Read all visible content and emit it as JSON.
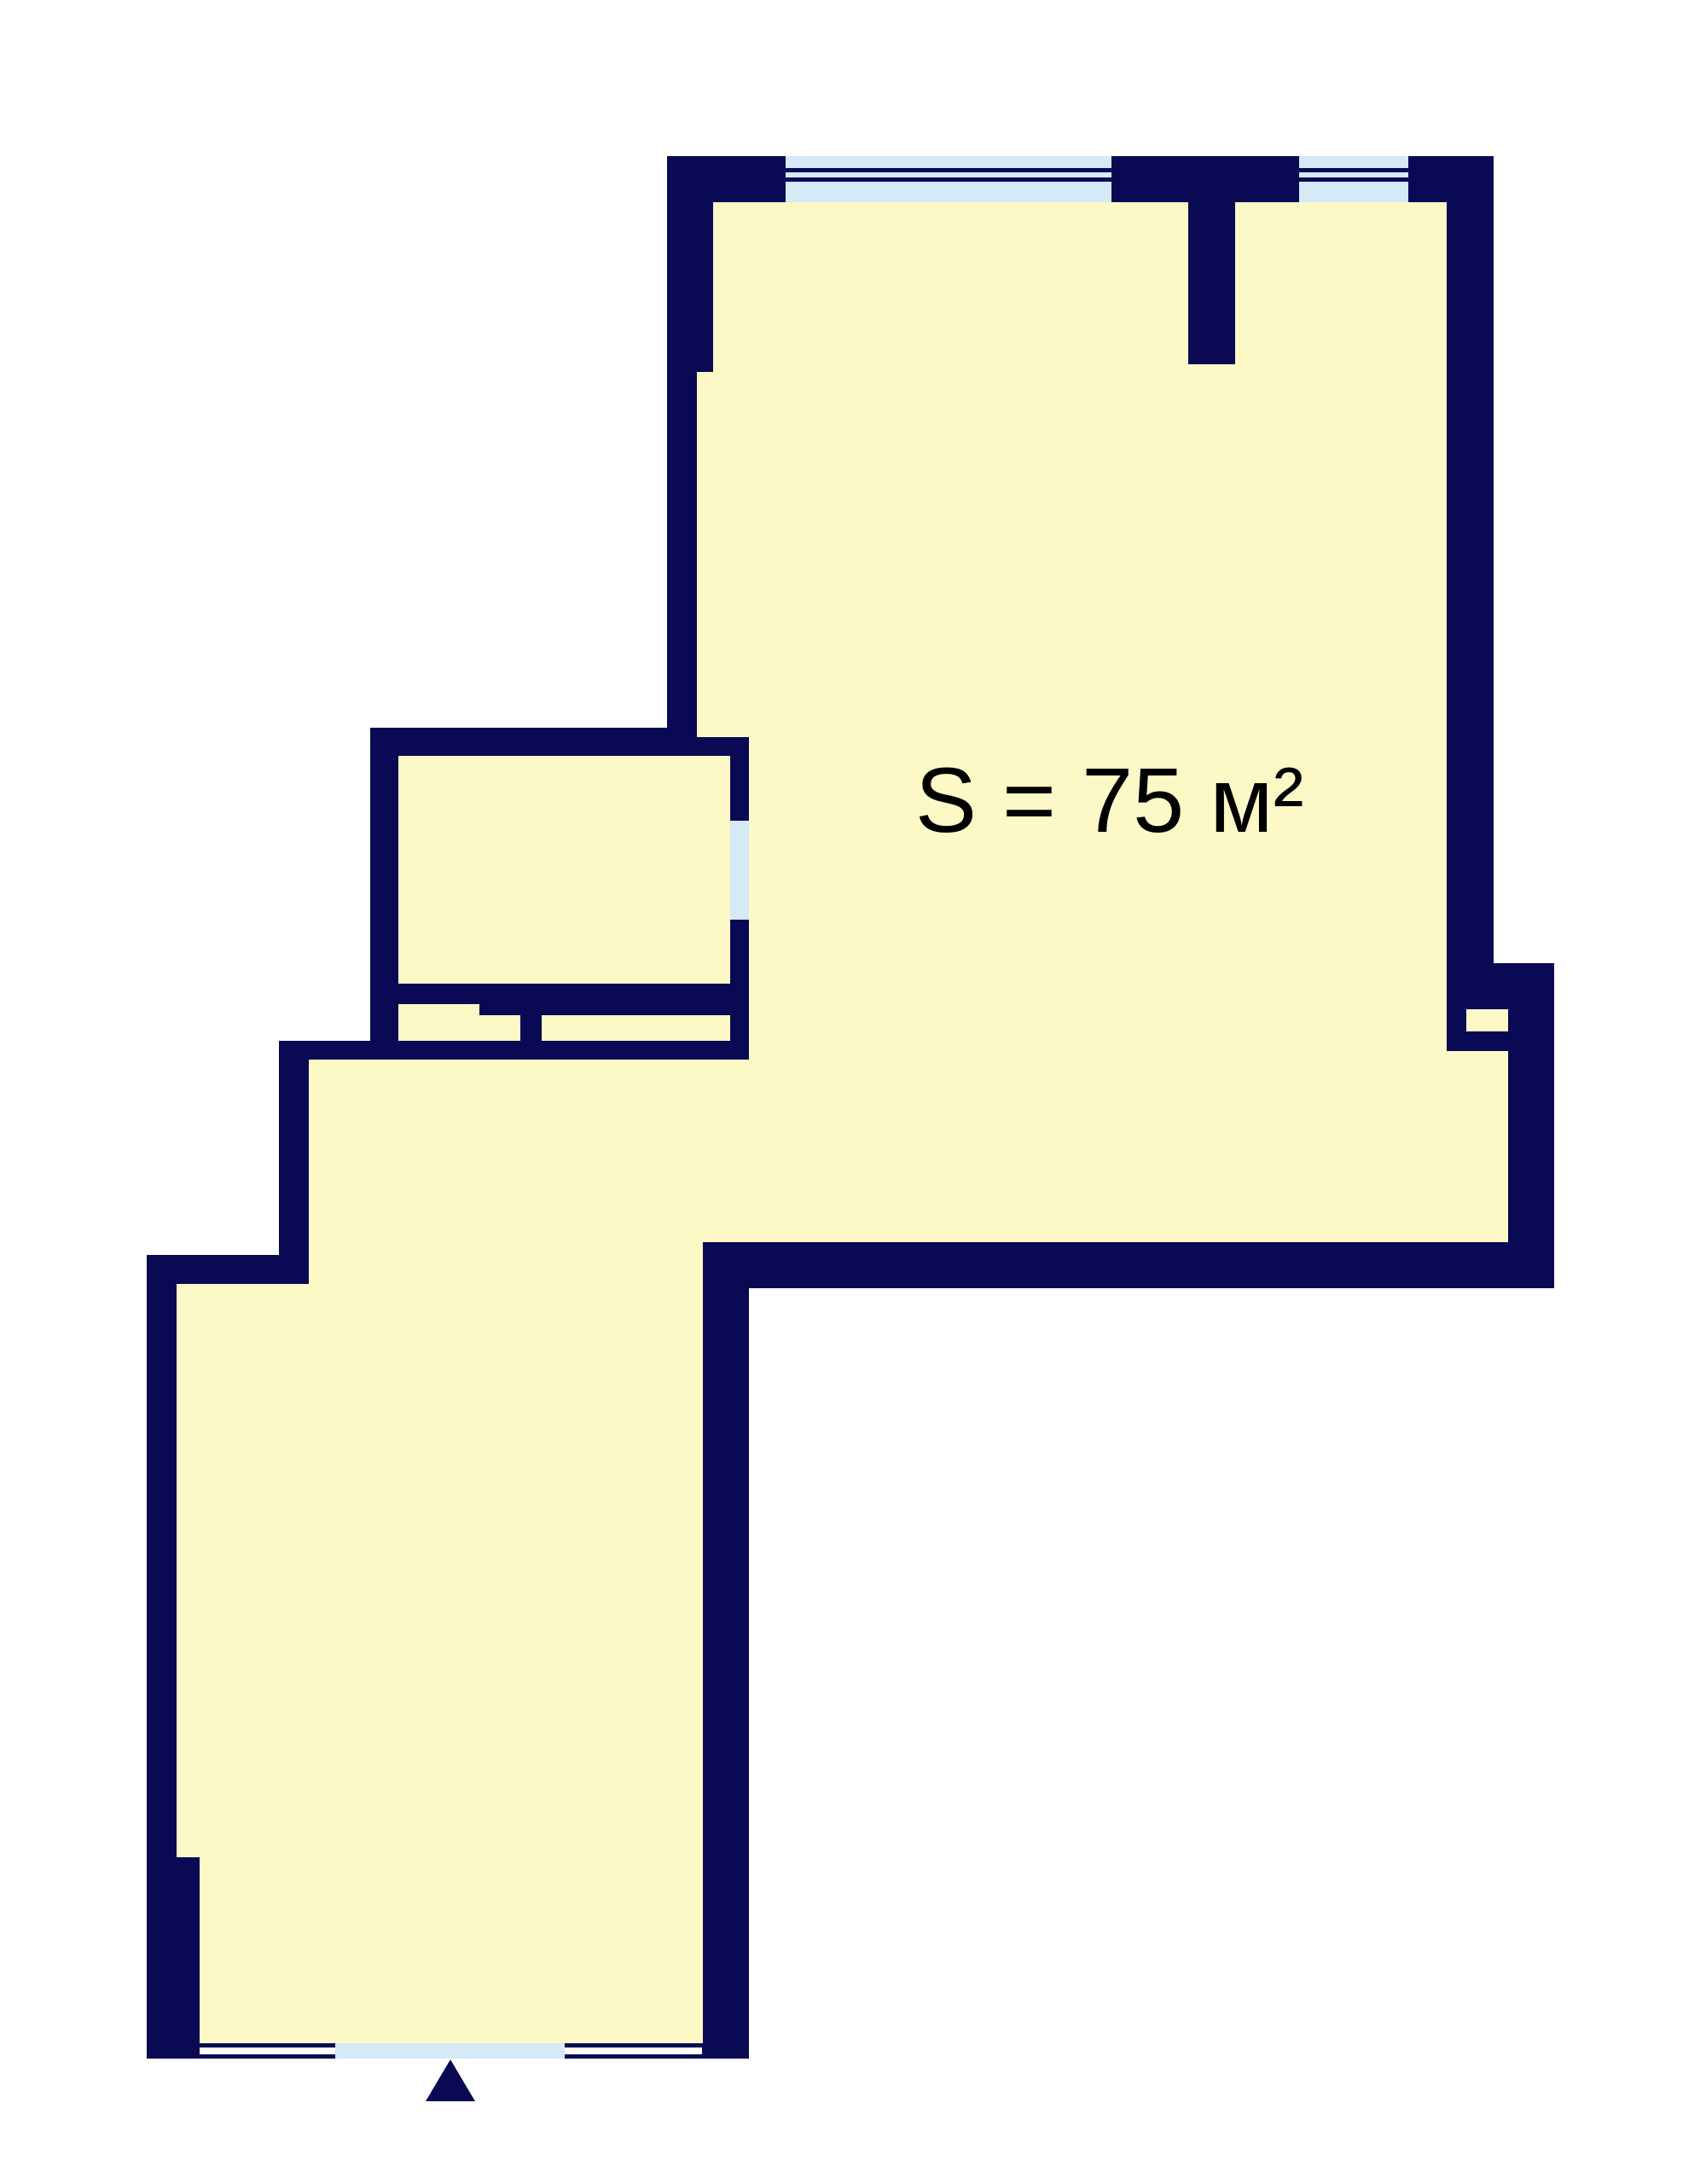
{
  "floorplan": {
    "area_label": "S = 75 м²",
    "colors": {
      "wall": "#0a0a54",
      "floor": "#fcf9c6",
      "window": "#d5e9f7",
      "background": "#ffffff",
      "label": "#000000"
    }
  }
}
